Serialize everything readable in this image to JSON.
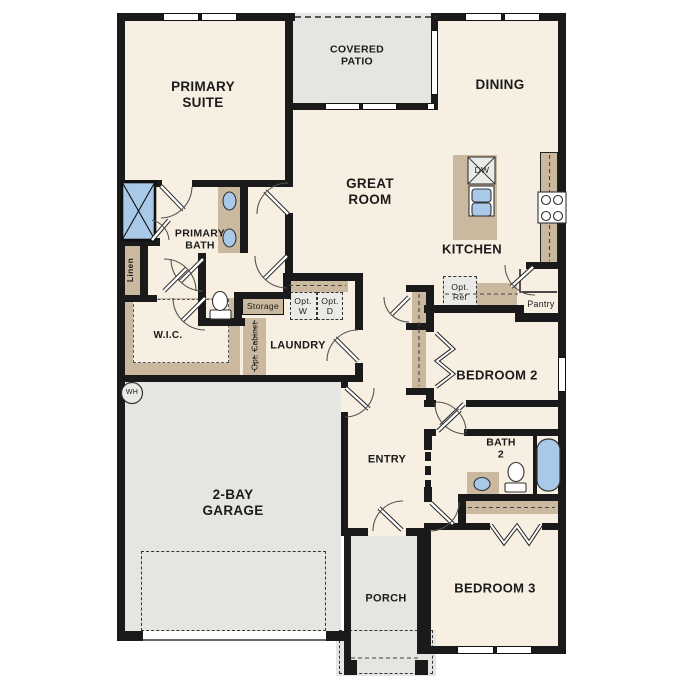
{
  "plan": {
    "title": "single-story-floor-plan",
    "rooms": {
      "primary_suite": "PRIMARY SUITE",
      "covered_patio": "COVERED PATIO",
      "dining": "DINING",
      "great_room": "GREAT ROOM",
      "kitchen": "KITCHEN",
      "primary_bath": "PRIMARY BATH",
      "wic": "W.I.C.",
      "laundry": "LAUNDRY",
      "entry": "ENTRY",
      "garage": "2-BAY GARAGE",
      "porch": "PORCH",
      "bedroom2": "BEDROOM 2",
      "bath2": "BATH 2",
      "bedroom3": "BEDROOM 3"
    },
    "features": {
      "linen": "Linen",
      "storage": "Storage",
      "opt_cabinet": "Opt. Cabinet",
      "opt_w": "Opt. W",
      "opt_d": "Opt. D",
      "opt_ref": "Opt. Ref",
      "pantry": "Pantry",
      "dw": "DW",
      "wh": "WH"
    },
    "colors": {
      "wall": "#1a1a1a",
      "room": "#f7efe1",
      "hard": "#e5e5e2",
      "cab": "#cab99e",
      "fixture": "#a9c9e9",
      "optbox": "#eaeae7"
    }
  }
}
